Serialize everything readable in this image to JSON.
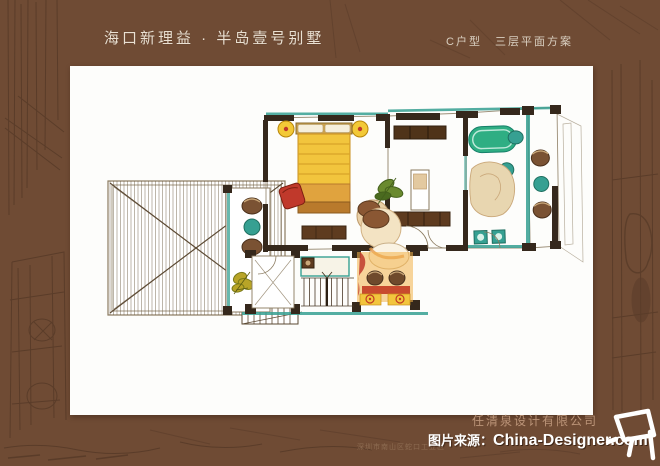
{
  "header": {
    "title": "海口新理益 · 半岛壹号别墅",
    "scheme": "C户型　三层平面方案"
  },
  "plan": {
    "kind": "hand-drawn watercolor floor plan, third floor of villa unit C",
    "features": [
      "hip-roof terrace",
      "side balcony",
      "bedroom",
      "hallway",
      "bathroom",
      "rear balcony",
      "staircase",
      "tea room"
    ]
  },
  "footer": {
    "company": "任清泉设计有限公司",
    "address": "深圳市南山区蛇口工业区",
    "watermark": {
      "prefix": "图片来源：",
      "brand": "China-Designer.com"
    }
  },
  "colors": {
    "bg": "#6f4b34",
    "sketch": "#3f2a1c",
    "card": "#fdfdfb",
    "title": "#eae0d2",
    "subtitle": "#d9cfc0",
    "company": "#bb9478",
    "address": "#96755a",
    "watermark": "#ffffff",
    "teal": "#36a092",
    "green": "#2fae83",
    "yellow": "#f2c53d",
    "orange": "#e59a4b",
    "red": "#c0392b",
    "brown": "#6f4a2c",
    "tan": "#e8d6b0",
    "wall": "#35281c",
    "line": "#8a7a5f"
  }
}
